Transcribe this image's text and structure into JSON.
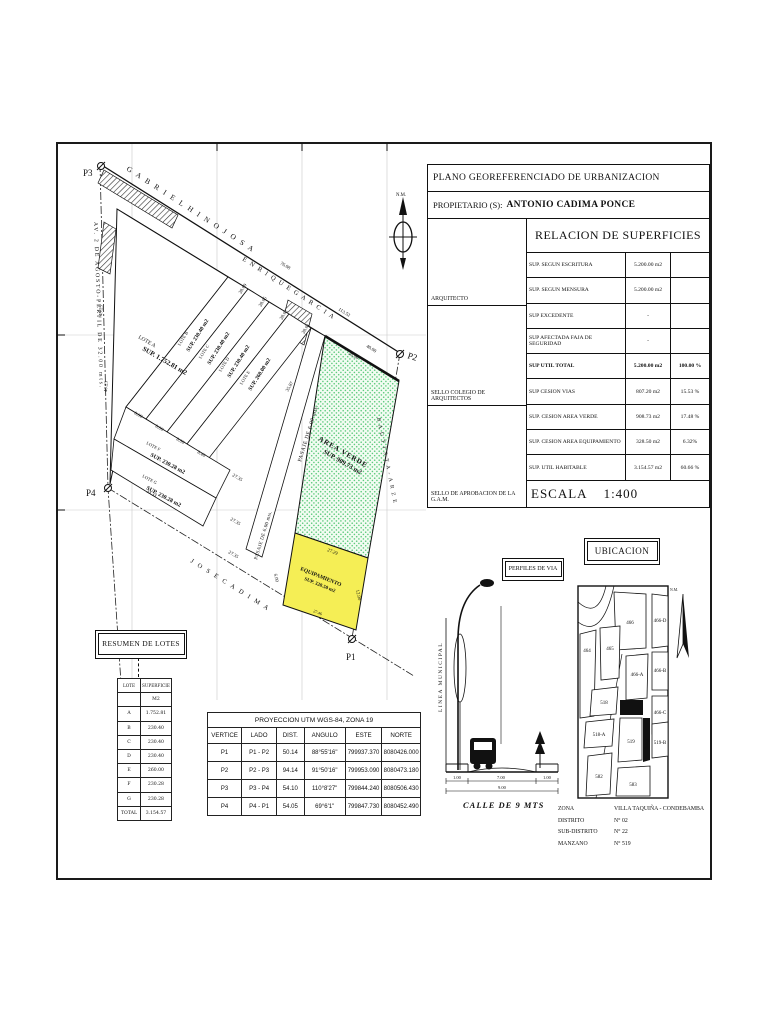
{
  "sheet": {
    "title": "PLANO GEOREFERENCIADO DE URBANIZACION",
    "owner_label": "PROPIETARIO (S):",
    "owner_value": "ANTONIO CADIMA PONCE",
    "relacion": {
      "title": "RELACION DE SUPERFICIES",
      "rows": [
        {
          "name": "SUP. SEGUN ESCRITURA",
          "value": "5.200.00 m2",
          "pct": ""
        },
        {
          "name": "SUP. SEGUN MENSURA",
          "value": "5.200.00 m2",
          "pct": ""
        },
        {
          "name": "SUP EXCEDENTE",
          "value": "-",
          "pct": ""
        },
        {
          "name": "SUP AFECTADA FAJA DE SEGURIDAD",
          "value": "-",
          "pct": ""
        },
        {
          "name": "SUP UTIL TOTAL",
          "value": "5.200.00 m2",
          "pct": "100.00 %"
        },
        {
          "name": "SUP CESION VIAS",
          "value": "807.20 m2",
          "pct": "15.53 %"
        },
        {
          "name": "SUP. CESION AREA VERDE",
          "value": "908.73 m2",
          "pct": "17.48 %"
        },
        {
          "name": "SUP. CESION AREA EQUIPAMIENTO",
          "value": "328.50 m2",
          "pct": "6.32%"
        },
        {
          "name": "SUP. UTIL HABITABLE",
          "value": "3.154.57 m2",
          "pct": "60.66 %"
        }
      ],
      "arquitecto": "ARQUITECTO",
      "sello_colegio": "SELLO  COLEGIO DE ARQUITECTOS",
      "sello_gam": "SELLO DE APROBACION DE LA G.A.M.",
      "escala_label": "ESCALA",
      "escala_value": "1:400"
    }
  },
  "plan": {
    "north_label": "N.M.",
    "markers": {
      "p1": "P1",
      "p2": "P2",
      "p3": "P3",
      "p4": "P4"
    },
    "streets": {
      "gabriel": "G A B R I E L   H I N O J O S A",
      "enrique": "E N R I Q U E   G A R C I A",
      "agosto": "AV. 2 DE AGOSTO-PERFIL DE 32.00 mts.",
      "jose": "J O S E   C A D I M A",
      "bautista": "B A U T I S T A - A R Z E",
      "pasaje1": "PASAJE DE 6.00 mts.",
      "pasaje2": "PASAJE DE 6.00 mts."
    },
    "lots": {
      "a_name": "LOTE A",
      "a_sup": "SUP. 1.752.81 m2",
      "b_name": "LOTE B",
      "b_sup": "SUP. 230.40 m2",
      "c_name": "LOTE C",
      "c_sup": "SUP. 230.40 m2",
      "d_name": "LOTE D",
      "d_sup": "SUP. 230.40 m2",
      "e_name": "LOTE E",
      "e_sup": "SUP. 260.00 m2",
      "f_name": "LOTE F",
      "f_sup": "SUP. 230.28 m2",
      "g_name": "LOTE G",
      "g_sup": "SUP. 230.28 m2",
      "verde_name": "AREA VERDE",
      "verde_sup": "SUP. 909.73 m2",
      "equip_name": "EQUIPAMIENTO",
      "equip_sup": "SUP. 328.50 m2"
    },
    "dims": {
      "street_len": "113.52",
      "street_seg": "76.08",
      "street_seg2": "40.00",
      "west1": "49.25",
      "west2": "40.23",
      "p4_side": "33.33",
      "b_len": "28.69",
      "c_len": "28.65",
      "d_len": "28.62",
      "e_len": "28.61",
      "w1": "8.00",
      "w2": "8.00",
      "w3": "8.00",
      "w4": "8.40",
      "f_top": "27.35",
      "g_top": "27.35",
      "g_bottom": "27.35",
      "jose_gap": "6.00",
      "verde_top": "20.00",
      "pasaje_len": "35.87",
      "equip_top": "27.29",
      "equip_bottom": "27.46",
      "equip_side": "12.00"
    }
  },
  "resumen": {
    "box_title": "RESUMEN DE LOTES",
    "rows": [
      [
        "LOTE",
        "SUPERFICIE"
      ],
      [
        "",
        "M2"
      ],
      [
        "A",
        "1.752.81"
      ],
      [
        "B",
        "230.40"
      ],
      [
        "C",
        "230.40"
      ],
      [
        "D",
        "230.40"
      ],
      [
        "E",
        "260.00"
      ],
      [
        "F",
        "230.28"
      ],
      [
        "G",
        "230.28"
      ],
      [
        "TOTAL",
        "3.154.57"
      ]
    ]
  },
  "utm": {
    "title": "PROYECCION UTM WGS-84, ZONA 19",
    "headers": [
      "VERTICE",
      "LADO",
      "DIST.",
      "ANGULO",
      "ESTE",
      "NORTE"
    ],
    "rows": [
      [
        "P1",
        "P1 - P2",
        "50.14",
        "88°55'16\"",
        "799937.370",
        "8080426.000"
      ],
      [
        "P2",
        "P2 - P3",
        "94.14",
        "91°50'16\"",
        "799953.090",
        "8080473.180"
      ],
      [
        "P3",
        "P3 - P4",
        "54.10",
        "110°8'27\"",
        "799844.240",
        "8080506.430"
      ],
      [
        "P4",
        "P4 - P1",
        "54.05",
        "69°6'1\"",
        "799847.730",
        "8080452.490"
      ]
    ]
  },
  "perfiles": {
    "title": "PERFILES DE VIA",
    "linea": "LINEA MUNICIPAL",
    "calle": "CALLE DE 9 MTS",
    "dim_left": "1.00",
    "dim_center": "7.00",
    "dim_right": "1.00",
    "dim_total": "9.00"
  },
  "ubicacion": {
    "title": "UBICACION",
    "north_label": "N.M.",
    "blocks": {
      "b466": "466",
      "b466d": "466-D",
      "b464": "464",
      "b465": "465",
      "b466a": "466-A",
      "b466b": "466-B",
      "b466c": "466-C",
      "b518": "518",
      "b518a": "518-A",
      "b519": "519",
      "b519a": "519-A",
      "b519b": "519-B",
      "b582": "582",
      "b583": "583"
    },
    "info": [
      {
        "label": "ZONA",
        "value": "VILLA TAQUIÑA - CONDEBAMBA"
      },
      {
        "label": "DISTRITO",
        "value": "N° 02"
      },
      {
        "label": "SUB-DISTRITO",
        "value": "N° 22"
      },
      {
        "label": "MANZANO",
        "value": "N° 519"
      }
    ]
  }
}
